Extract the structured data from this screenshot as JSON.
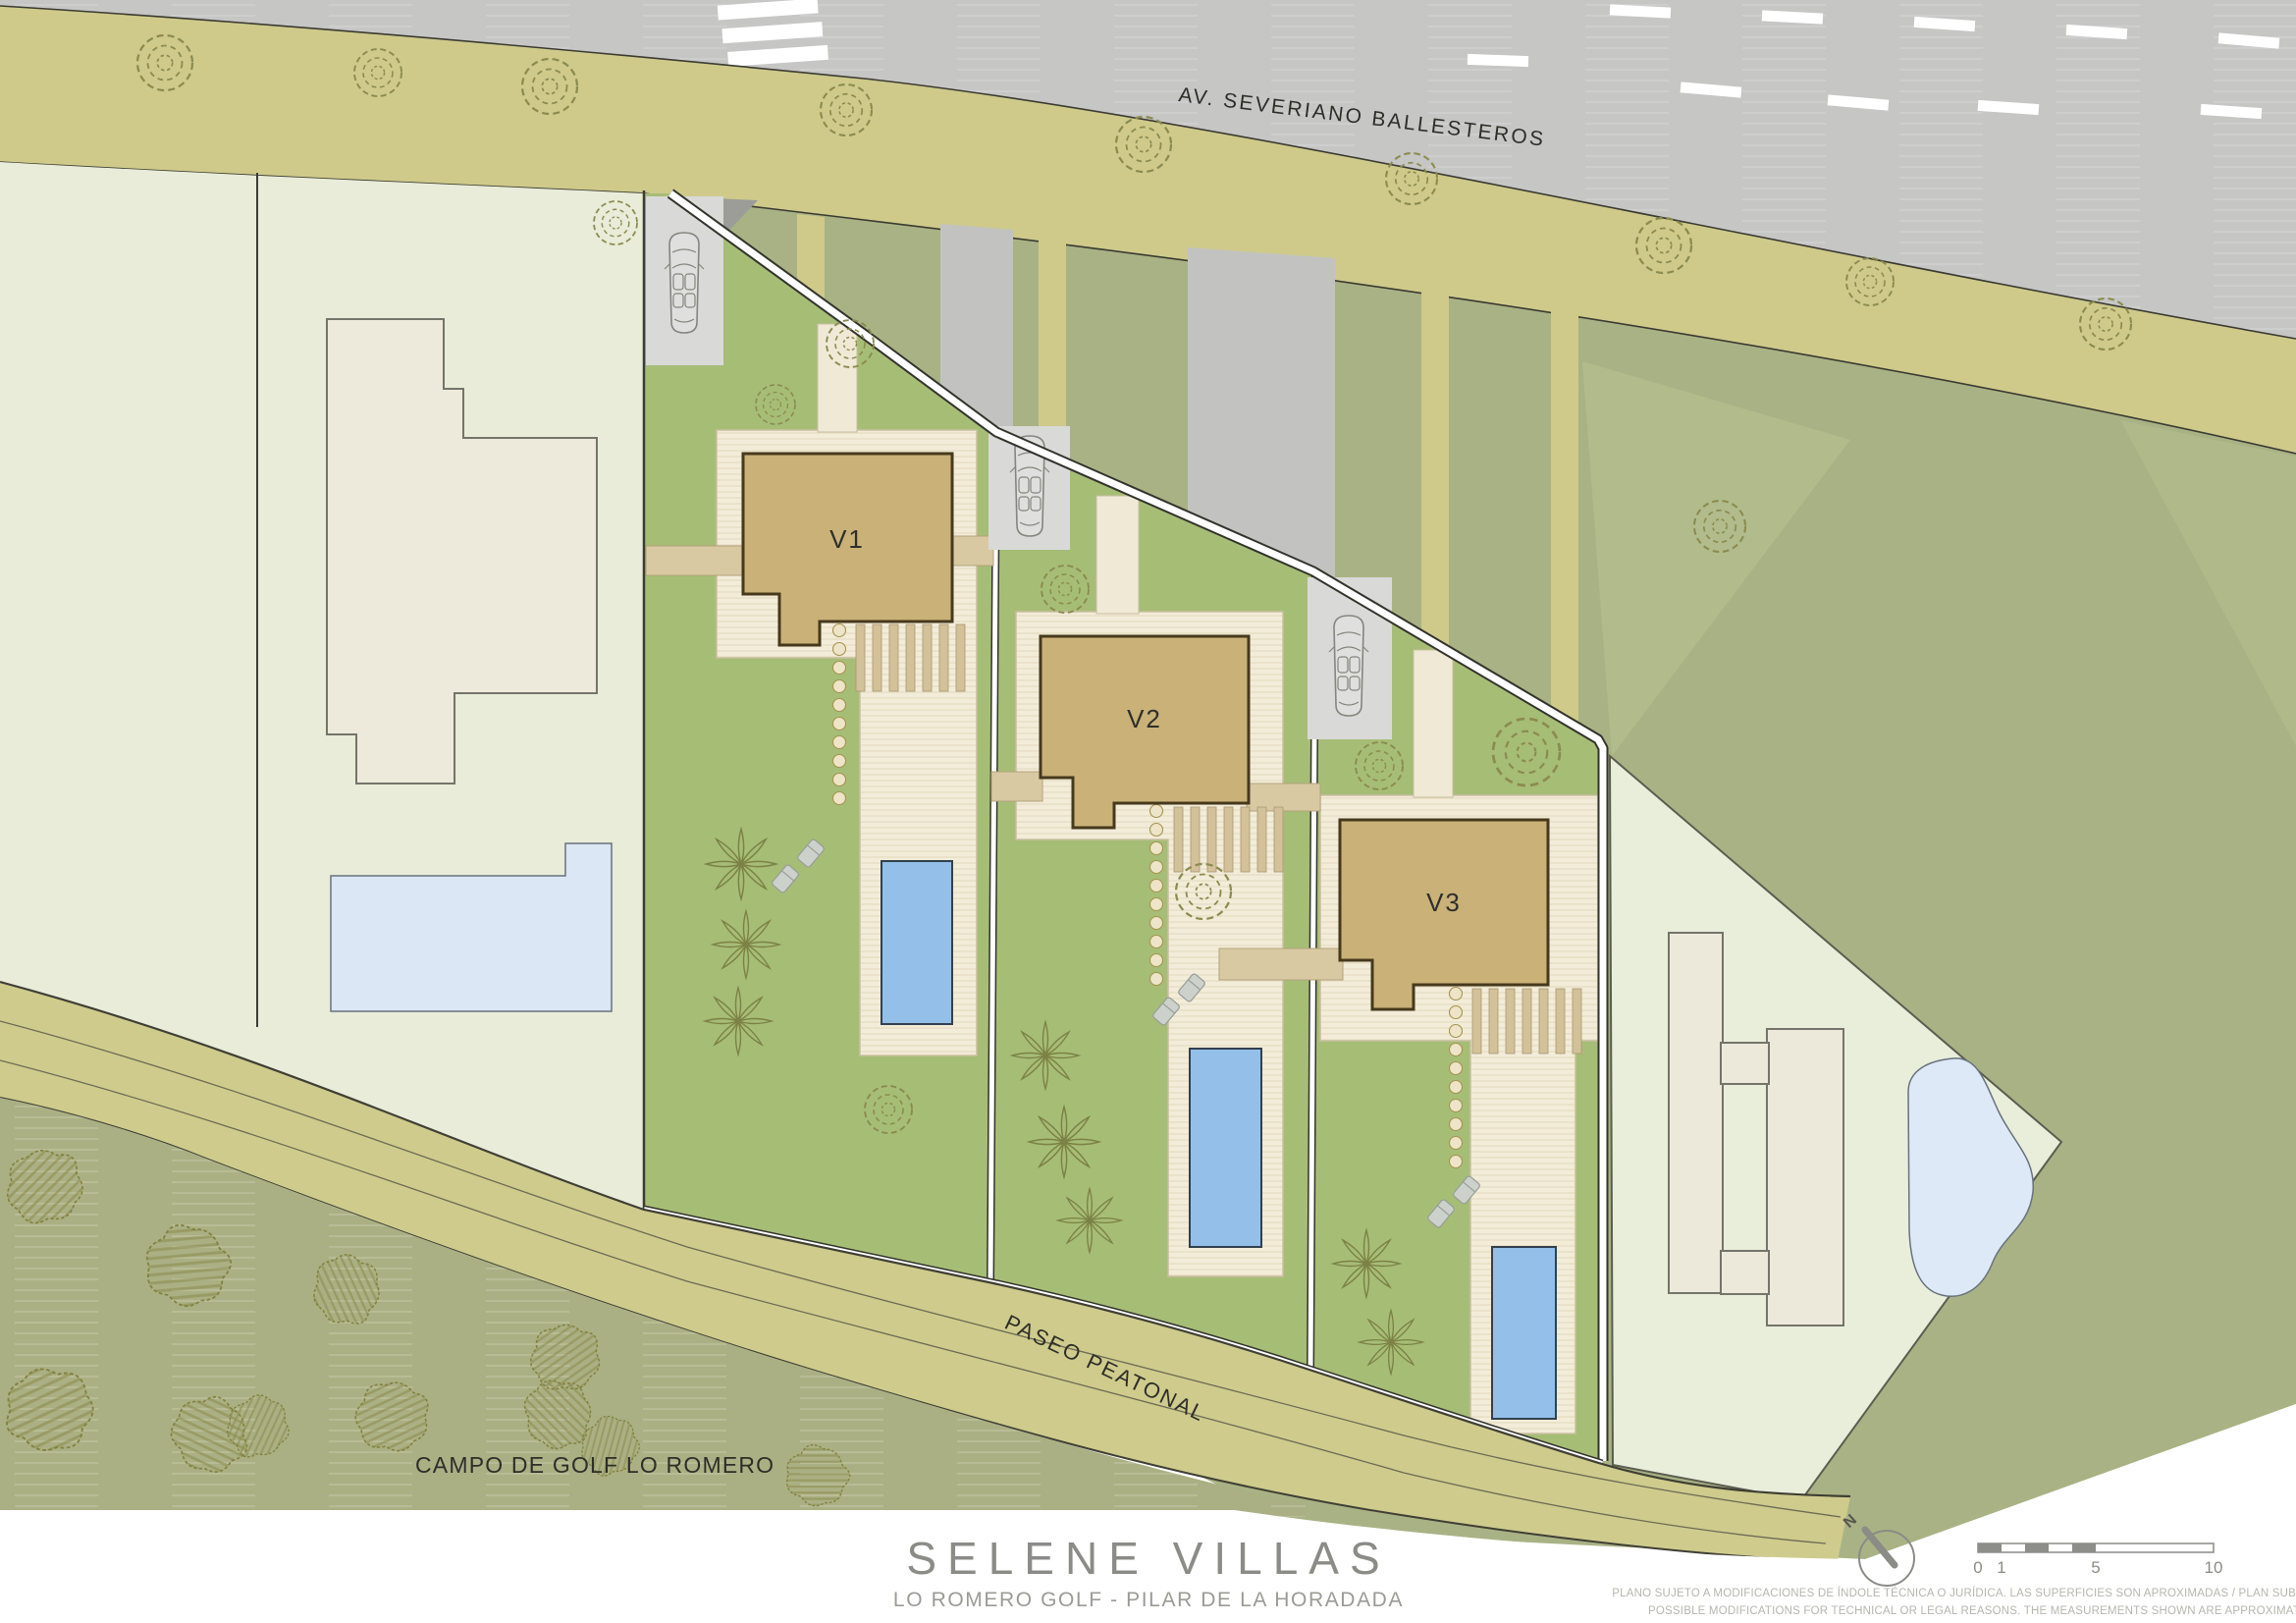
{
  "plan": {
    "street_label": "AV. SEVERIANO BALLESTEROS",
    "path_label": "PASEO PEATONAL",
    "golf_label": "CAMPO DE GOLF LO ROMERO",
    "villas": [
      {
        "label": "V1"
      },
      {
        "label": "V2"
      },
      {
        "label": "V3"
      }
    ],
    "compass_label": "N"
  },
  "title_block": {
    "title": "SELENE VILLAS",
    "subtitle": "LO ROMERO GOLF  -  PILAR DE LA HORADADA",
    "disclaimer_line1": "PLANO SUJETO A MODIFICACIONES DE ÍNDOLE TÉCNICA O JURÍDICA. LAS SUPERFICIES SON APROXIMADAS / PLAN SUBJECT TO",
    "disclaimer_line2": "POSSIBLE MODIFICATIONS FOR TECHNICAL OR LEGAL REASONS. THE MEASUREMENTS SHOWN ARE APPROXIMATE",
    "scale_labels": [
      "0",
      "1",
      "5",
      "10"
    ]
  },
  "colors": {
    "road": "#c6c6c5",
    "sidewalk": "#cfca8a",
    "sage": "#a9b284",
    "villa_lawn": "#a6bd76",
    "pale_plot": "#e8ecd8",
    "terrace": "#f2ecd9",
    "house": "#c9b178",
    "pool": "#93bfe9",
    "pond": "#dde9f6",
    "golf": "#abb084",
    "wall": "#ffffff"
  }
}
